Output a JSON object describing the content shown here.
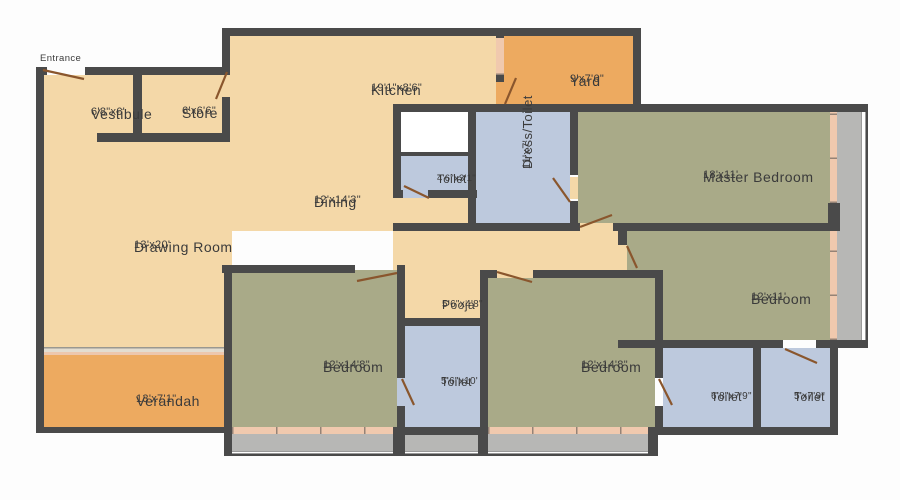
{
  "title": "Apartment Floor Plan",
  "entrance_label": "Entrance",
  "palette": {
    "floor_tan": "#f4d8a8",
    "floor_orange": "#edaa60",
    "floor_green": "#a9aa88",
    "floor_blue": "#bdc9dd",
    "wall_gray": "#4a4a4a",
    "balcony_gray": "#b7b7b5",
    "window_pink": "#f0c9ae",
    "door_brown": "#8a562d",
    "text_dark": "#3b3b3b",
    "bg_white": "#fdfdfd"
  },
  "rooms": [
    {
      "name": "Vestibule",
      "dims": "6'8\"x6'"
    },
    {
      "name": "Store",
      "dims": "6'x6'6\""
    },
    {
      "name": "Kitchen",
      "dims": "19'1\"x8'6\""
    },
    {
      "name": "Yard",
      "dims": "9'x7'6\""
    },
    {
      "name": "Dining",
      "dims": "12'x14'3\""
    },
    {
      "name": "Drawing Room",
      "dims": "13'x20'"
    },
    {
      "name": "Toilet",
      "dims": "4'6\"x3'1\""
    },
    {
      "name": "Dress/Toilet",
      "dims": "11'x7'"
    },
    {
      "name": "Master Bedroom",
      "dims": "18'x11'"
    },
    {
      "name": "Bedroom",
      "dims": "12'x11'"
    },
    {
      "name": "Pooja",
      "dims": "5'6\"x4'8\""
    },
    {
      "name": "Bedroom",
      "dims": "12'x14'8\""
    },
    {
      "name": "Toilet",
      "dims": "5'6\"x10'"
    },
    {
      "name": "Bedroom",
      "dims": "12'x14'8\""
    },
    {
      "name": "Toilet",
      "dims": "6'8\"x7'9\""
    },
    {
      "name": "Toilet",
      "dims": "5'x7'9\""
    },
    {
      "name": "Verandah",
      "dims": "13'x7'1\""
    }
  ]
}
